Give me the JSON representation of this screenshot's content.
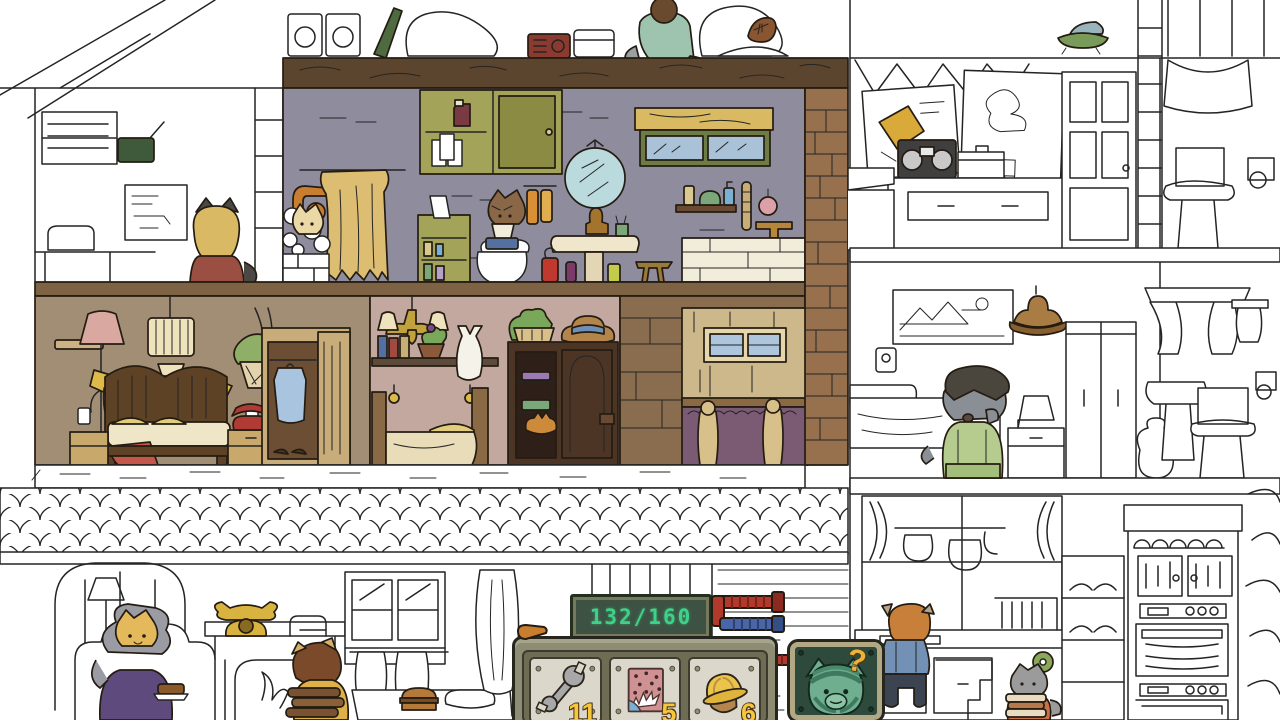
{
  "game": {
    "counter": {
      "value": "132/160"
    },
    "toolbar": {
      "tools": [
        {
          "name": "wrench",
          "icon": "wrench-icon",
          "count": "11"
        },
        {
          "name": "confetti-splash",
          "icon": "confetti-splash-icon",
          "count": "5"
        },
        {
          "name": "hard-hat",
          "icon": "hard-hat-icon",
          "count": "6"
        }
      ]
    },
    "hint": {
      "question_mark": "?"
    }
  },
  "colors": {
    "counter_text": "#3ed189",
    "counter_panel": "#3d5243",
    "toolbar_frame": "#8e8c73",
    "tool_plate": "#dbd7ca",
    "count_text": "#f6c63d",
    "hint_panel": "#2e4a3c",
    "hint_cat": "#6fae8e",
    "question_mark": "#eab33c",
    "pipe_red": "#b23a2c",
    "pipe_blue": "#4a66a8"
  }
}
